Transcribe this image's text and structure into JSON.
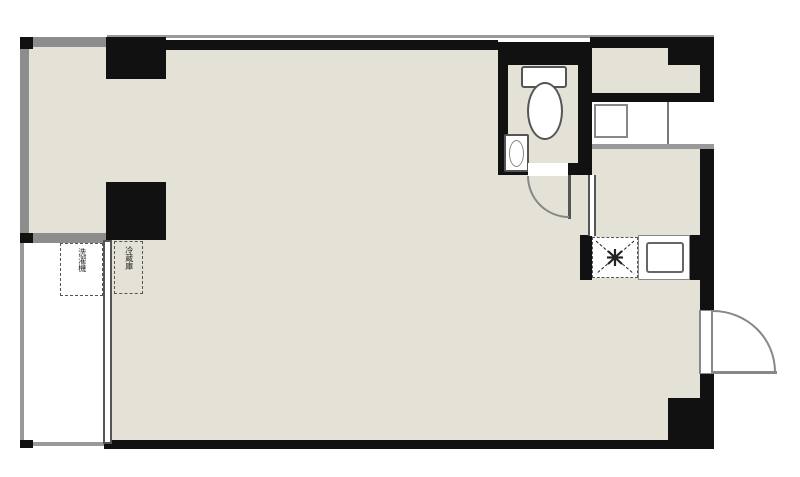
{
  "document": {
    "type": "apartment-floor-plan",
    "style": "one-room layout with balcony, toilet, kitchen counter and entrance"
  },
  "labels": {
    "washing_machine": "洗濯機",
    "refrigerator": "冷蔵庫"
  },
  "colors": {
    "background": "#ffffff",
    "room_fill": "#e4e2d6",
    "wall_black": "#111111",
    "wall_gray": "#8d8d8d",
    "rail_gray": "#999999",
    "line_gray": "#777777"
  },
  "fixtures": [
    "toilet",
    "toilet-tank",
    "hand-basin",
    "kitchen-cabinets",
    "gas-stove",
    "kitchen-sink",
    "toilet-door",
    "entrance-door",
    "balcony-window",
    "washing-machine-space",
    "refrigerator-space"
  ]
}
